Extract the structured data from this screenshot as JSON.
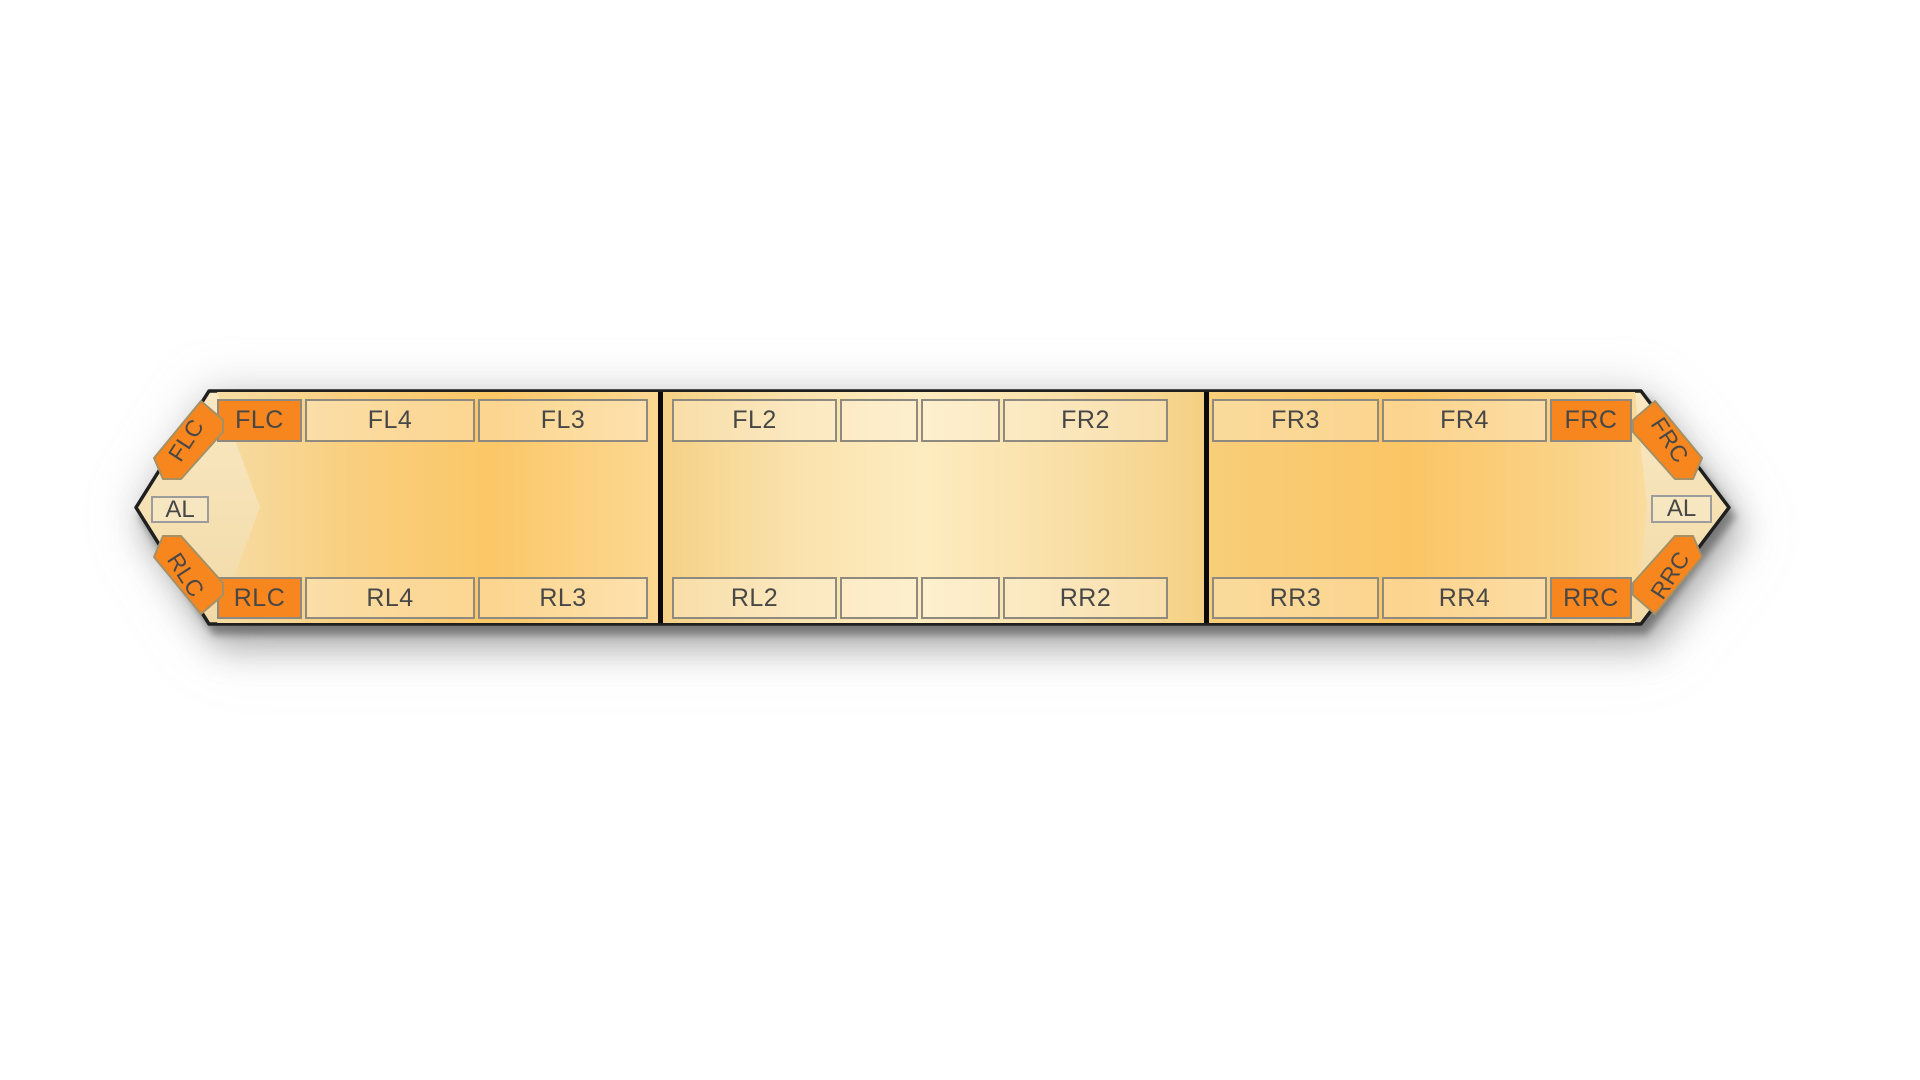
{
  "lightbar": {
    "description": "lightbar-module-layout-diagram",
    "left_end": {
      "corner_top_label": "FLC",
      "alley_label": "AL",
      "corner_bottom_label": "RLC"
    },
    "right_end": {
      "corner_top_label": "FRC",
      "alley_label": "AL",
      "corner_bottom_label": "RRC"
    },
    "sections": [
      {
        "id": "left",
        "top_row": [
          "FLC",
          "FL4",
          "FL3"
        ],
        "bottom_row": [
          "RLC",
          "RL4",
          "RL3"
        ]
      },
      {
        "id": "center",
        "top_row": [
          "FL2",
          "",
          "",
          "FR2"
        ],
        "bottom_row": [
          "RL2",
          "",
          "",
          "RR2"
        ]
      },
      {
        "id": "right",
        "top_row": [
          "FR3",
          "FR4",
          "FRC"
        ],
        "bottom_row": [
          "RR3",
          "RR4",
          "RRC"
        ]
      }
    ],
    "colors": {
      "module_orange": "#F6861D",
      "shell_cream": "#F5E0B2",
      "body_amber_dark": "#FBC565",
      "body_amber_light": "#FDECC0",
      "divider_black": "#0A0A0A",
      "slot_border_gray": "#8F8A80",
      "label_text": "#474747"
    }
  }
}
